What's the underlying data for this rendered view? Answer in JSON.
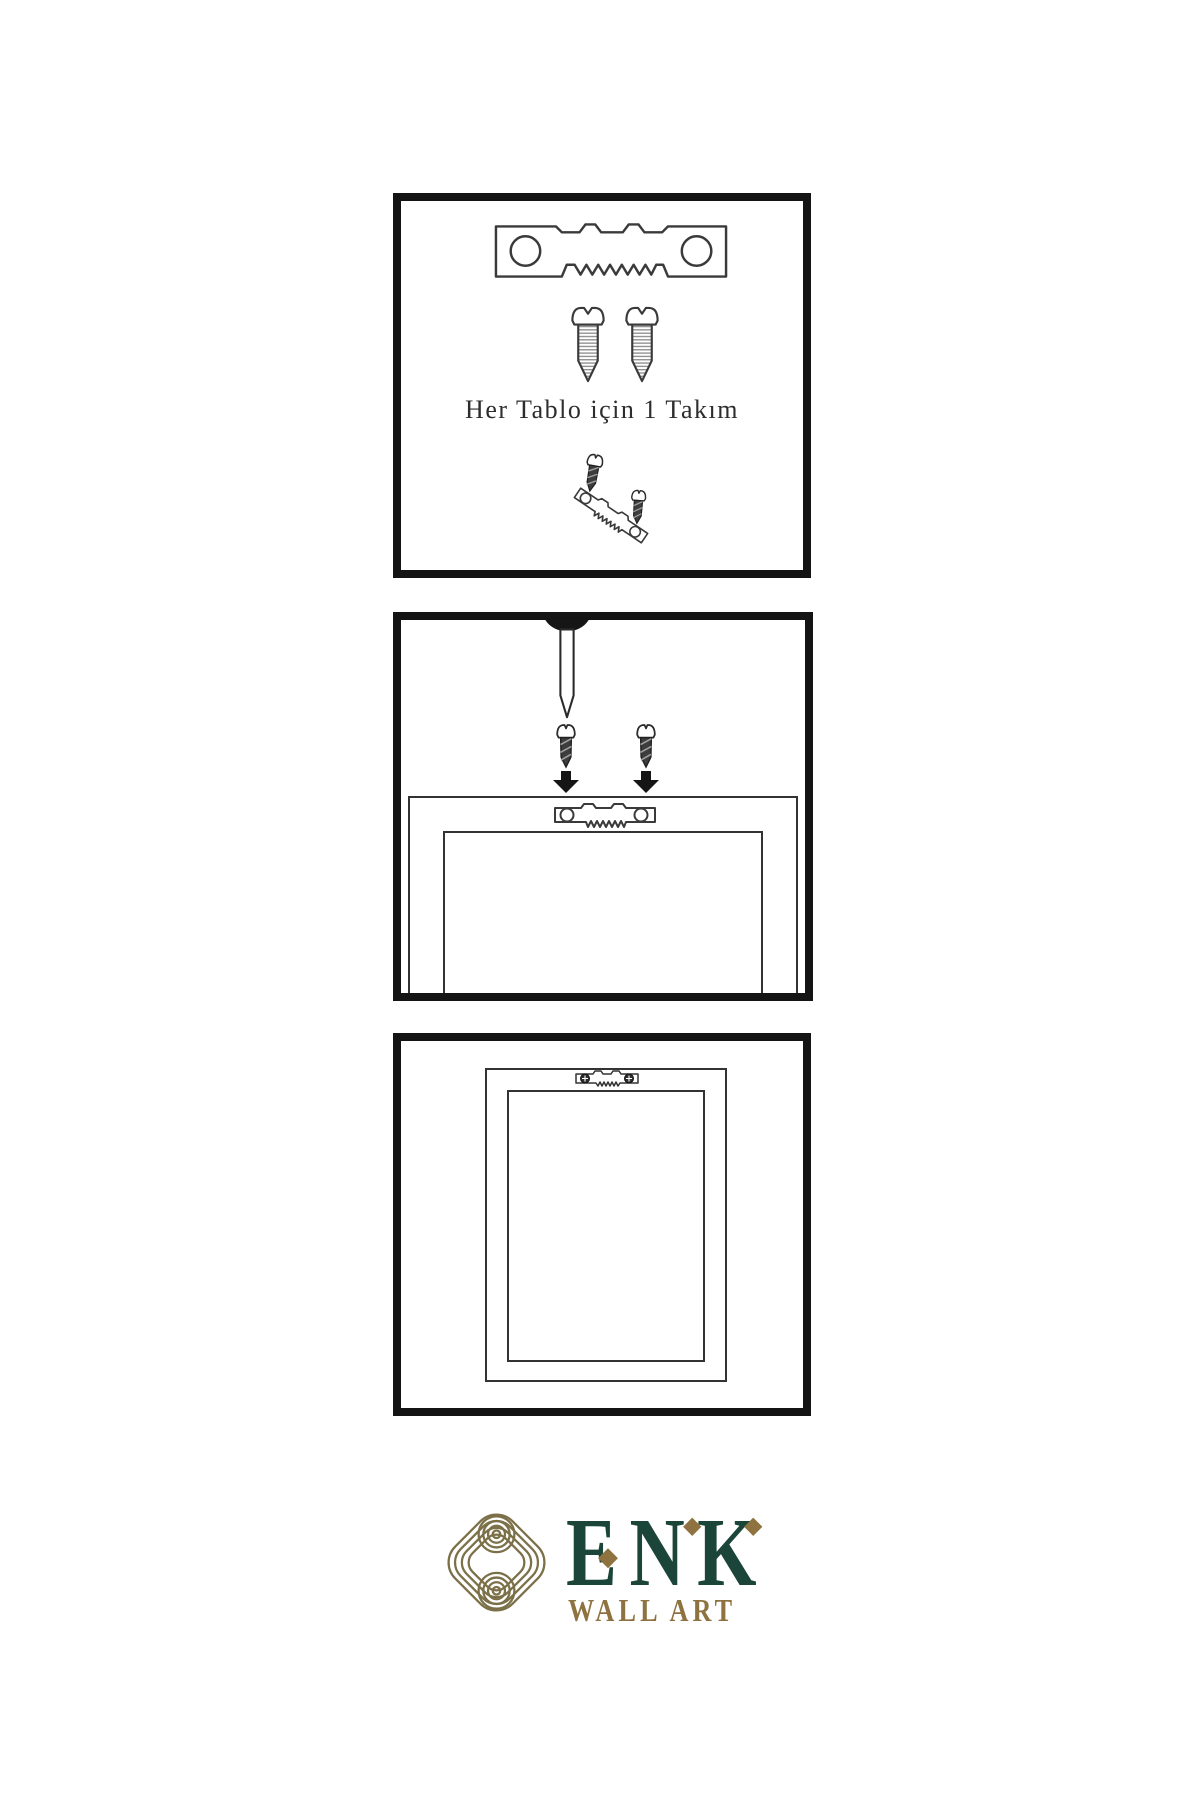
{
  "theme": {
    "page-bg": "#ffffff",
    "panel-border": "#141414",
    "line": "#333333",
    "text": "#2d2d2d",
    "brand-green": "#1b4539",
    "brand-gold": "#8e7340",
    "knot-gold": "#7b7048"
  },
  "steps": [
    {
      "name": "hardware-kit",
      "caption": "Her Tablo için 1 Takım"
    },
    {
      "name": "attach-hanger-to-frame-back"
    },
    {
      "name": "frame-hanging-on-wall"
    }
  ],
  "brand": {
    "name": "ENK",
    "letters": [
      "E",
      "N",
      "K"
    ],
    "diamond": "◆",
    "tagline": "WALL ART"
  }
}
